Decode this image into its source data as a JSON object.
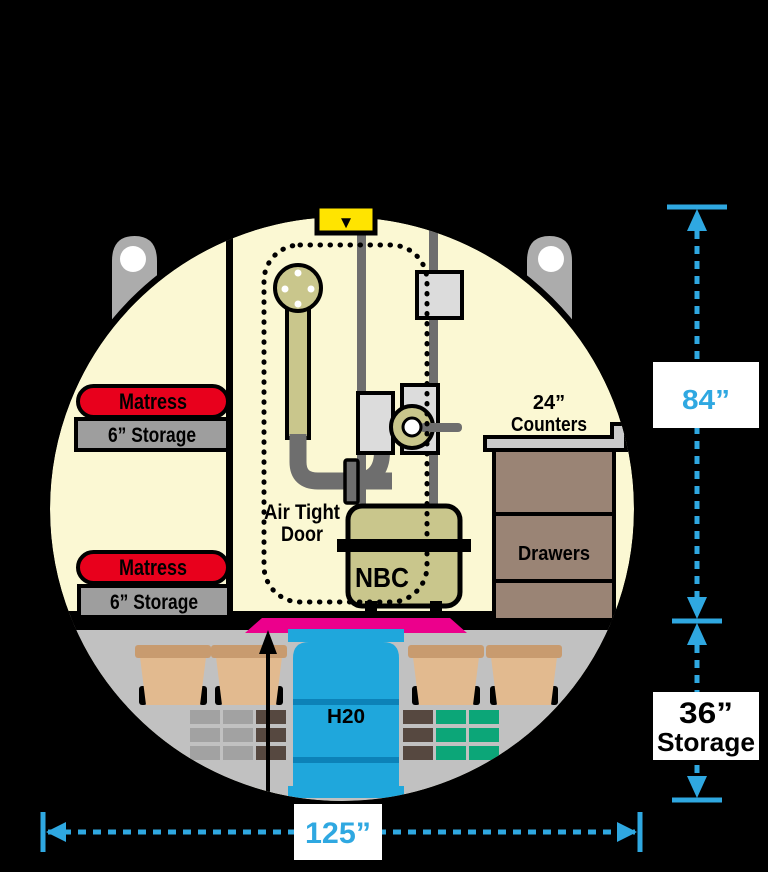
{
  "hatch": {
    "symbol": "▼"
  },
  "bunks": [
    {
      "mattress_label": "Matress",
      "storage_label": "6” Storage"
    },
    {
      "mattress_label": "Matress",
      "storage_label": "6” Storage"
    }
  ],
  "door": {
    "line1": "Air Tight",
    "line2": "Door"
  },
  "nbc_unit": {
    "label": "NBC"
  },
  "cabinet": {
    "counter_line1": "24”",
    "counter_line2": "Counters",
    "drawers_label": "Drawers"
  },
  "lower_storage": {
    "water_label": "H20"
  },
  "dimensions": {
    "interior_height": "84”",
    "storage_line1": "36”",
    "storage_line2": "Storage",
    "overall_width": "125”"
  },
  "colors": {
    "background": "#000000",
    "shelter_interior": "#FBF8D3",
    "floor_gray": "#C1C1C1",
    "accent_blue": "#2FA8E1",
    "mattress_red": "#E8001C",
    "bunk_gray": "#9E9E9E",
    "olive_equipment": "#C9C68C",
    "pipe_gray": "#6E6E6E",
    "machine_gray": "#DCDCDC",
    "cabinet_brown": "#9A8475",
    "counter_gray": "#CBCBCB",
    "hatch_yellow": "#FFE400",
    "doormat_pink": "#EC008C",
    "water_blue": "#1FA7DC",
    "water_band_blue": "#0C82B8",
    "bucket_tan": "#E2BA8F",
    "bucket_lid_tan": "#C89B6F",
    "bin_gray": "#A2A2A2",
    "bin_brown": "#564840",
    "bin_green": "#0CA678",
    "lug_gray": "#ACACAC",
    "label_box_white": "#FFFFFF"
  }
}
